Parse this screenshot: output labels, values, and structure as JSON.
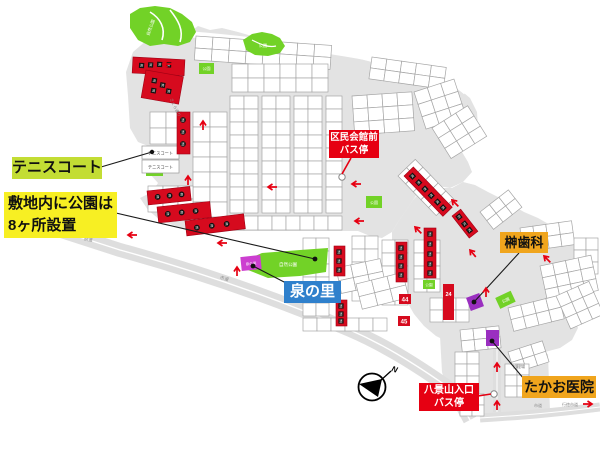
{
  "callouts": {
    "tennis": {
      "label": "テニスコート"
    },
    "parks_note": {
      "line1": "敷地内に公園は",
      "line2": "8ヶ所設置"
    },
    "kumin_bus": {
      "line1": "区民会館前",
      "line2": "バス停"
    },
    "sakaki": {
      "label": "榊歯科"
    },
    "izumi": {
      "label": "泉の里"
    },
    "hakkei_bus": {
      "line1": "八景山入口",
      "line2": "バス停"
    },
    "takao": {
      "label": "たかお医院"
    }
  },
  "map": {
    "park_label": "公園",
    "nature_park_label": "自然公園",
    "tennis_court_label": "テニスコート",
    "izumi_plot_label": "泉の里",
    "sold_glyph": "済",
    "lot_24": "24",
    "lot_44": "44",
    "lot_45": "45",
    "roads": {
      "sakura": "さくら通り",
      "kendo": "県道",
      "shido": "市道",
      "gyotoku": "行徳市道"
    },
    "facility": "処理場",
    "compass_n": "N"
  },
  "colors": {
    "label_green": "#c3dd34",
    "label_yellow": "#f7ef23",
    "label_red": "#e60012",
    "label_blue": "#2f80cc",
    "label_orange": "#f0a51d",
    "park_green": "#72d227",
    "sold_red": "#d60a1e",
    "magenta": "#cc3fd0",
    "purple": "#9a2fc0",
    "map_gray": "#e3e3e3",
    "arrow_red": "#e60012"
  }
}
